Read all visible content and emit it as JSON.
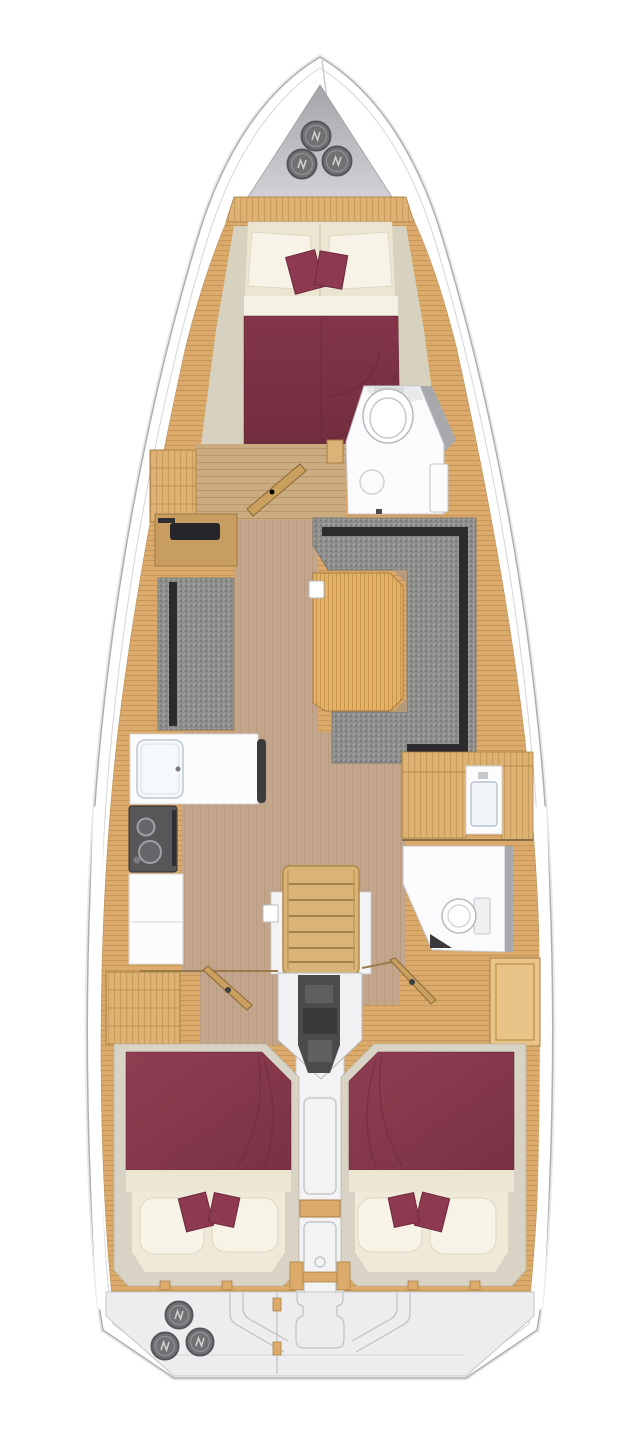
{
  "document": {
    "type": "sailing-yacht-interior-floor-plan",
    "visible_text": []
  },
  "colors": {
    "hull_stroke": "#adb0b3",
    "hull_inner_line": "#d4d5d7",
    "hull_fill": "#ffffff",
    "locker_top": "#a4a4a9",
    "locker_bottom": "#d2d2d6",
    "hatch_fill": "#717174",
    "hatch_rim": "#55555a",
    "hatch_ring": "#98989c",
    "hatch_glyph": "#d2d3d5",
    "wood_deck": "#dcab6c",
    "wood_line": "#b08046",
    "wood_cabinet": "#ddb273",
    "wood_frame": "#a8813f",
    "wood_rail": "#c9a05e",
    "floor_tan": "#c2a58a",
    "floor_fore": "#cbab80",
    "bed_maroon": "#7c3143",
    "bed_maroon_light": "#8d3c50",
    "bed_seam": "#5f2535",
    "cream": "#ece5d2",
    "pillow_white": "#f7f3e7",
    "accent_pillow": "#8d3950",
    "sofa_gray": "#8d8d8b",
    "sofa_trim": "#2c2c2e",
    "white_room": "#fbfbfd",
    "room_stroke": "#c3c4c7",
    "counter_white": "#fcfcfd",
    "appliance_dark": "#57575a",
    "engine_dark": "#4b4b4e",
    "steps_wood": "#dab377",
    "table_wood": "#e2b268",
    "transom": "#ededef",
    "transom_line": "#bfc1c3",
    "shelf_beige": "#d7d2c0",
    "underlay_beige": "#d8d3c4",
    "head_wall_gray": "#a8a9ad"
  },
  "hatches": {
    "bow": {
      "radius": 14.5,
      "positions": [
        [
          316,
          136
        ],
        [
          302,
          164
        ],
        [
          337,
          161
        ]
      ]
    },
    "stern": {
      "radius": 13.5,
      "positions": [
        [
          179,
          1315
        ],
        [
          165,
          1346
        ],
        [
          200,
          1342
        ]
      ]
    }
  },
  "equipment": {
    "bow_hatches": 3,
    "stern_hatches": 3,
    "stove_burners": 2,
    "cabins": 3,
    "heads": 2,
    "salon_tables": 1
  }
}
